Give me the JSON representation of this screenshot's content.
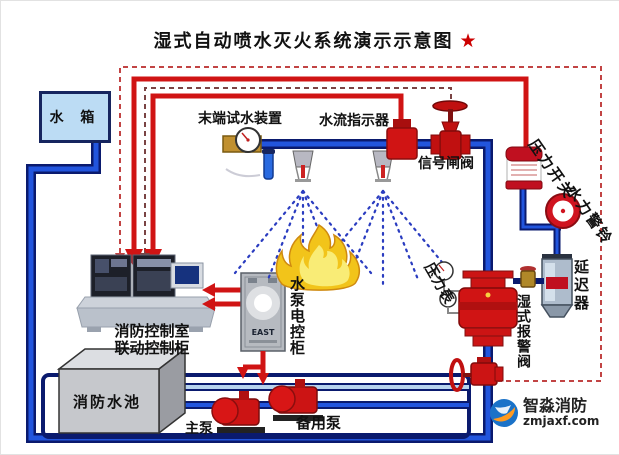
{
  "title": {
    "text": "湿式自动喷水灭火系统演示示意图",
    "star": "★"
  },
  "labels": {
    "water_tank": "水 箱",
    "end_test_device": "末端试水装置",
    "flow_indicator": "水流指示器",
    "signal_gate_valve": "信号闸阀",
    "pressure_switch": "压力开关",
    "hydraulic_alarm_bell": "水力警铃",
    "delayer": "延迟器",
    "wet_alarm_valve": "湿式报警阀",
    "pressure_gauge": "压力表",
    "control_room_line1": "消防控制室",
    "control_room_line2": "联动控制柜",
    "pump_control_cabinet": "水泵电控柜",
    "fire_pool": "消防水池",
    "main_pump": "主泵",
    "backup_pump": "备用泵"
  },
  "devices": {
    "pump_cabinet_brand": "EAST"
  },
  "watermark": {
    "name": "智淼消防",
    "site": "zmjaxf.com"
  },
  "colors": {
    "pipe_blue": "#2255dd",
    "pipe_edge": "#0a1a6e",
    "signal_red": "#d01414",
    "tank_fill": "#bcdcf4",
    "flame_yellow": "#f2c41a",
    "star_red": "#cc0000"
  }
}
